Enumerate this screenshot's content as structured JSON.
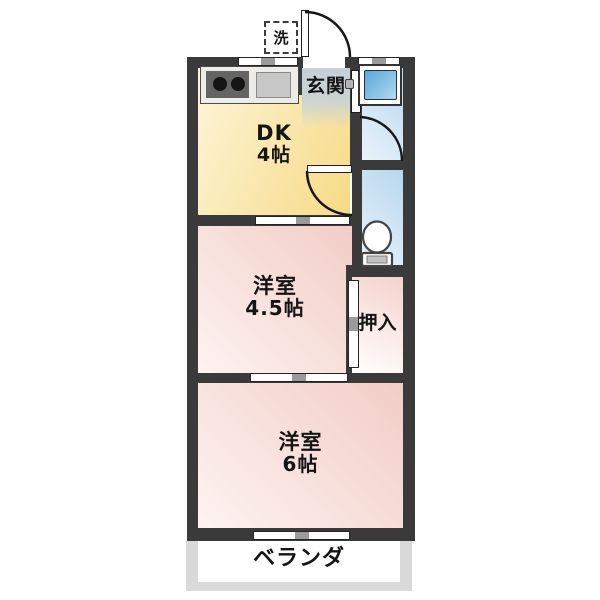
{
  "labels": {
    "dk_line1": "DK",
    "dk_line2": "4帖",
    "genkan": "玄関",
    "western45_line1": "洋室",
    "western45_line2": "4.5帖",
    "oshiire": "押入",
    "western6_line1": "洋室",
    "western6_line2": "6帖",
    "veranda": "ベランダ",
    "laundry": "洗"
  },
  "colors": {
    "wall": "#3a3a3a",
    "dk_yellow": "#f6da85",
    "genkan_gray": "#c6d0d8",
    "water_blue": "#b7d7ef",
    "bathtub_blue": "#58a8da",
    "room_pink": "#f2cdc6",
    "veranda_gray": "#d9d9d9"
  }
}
